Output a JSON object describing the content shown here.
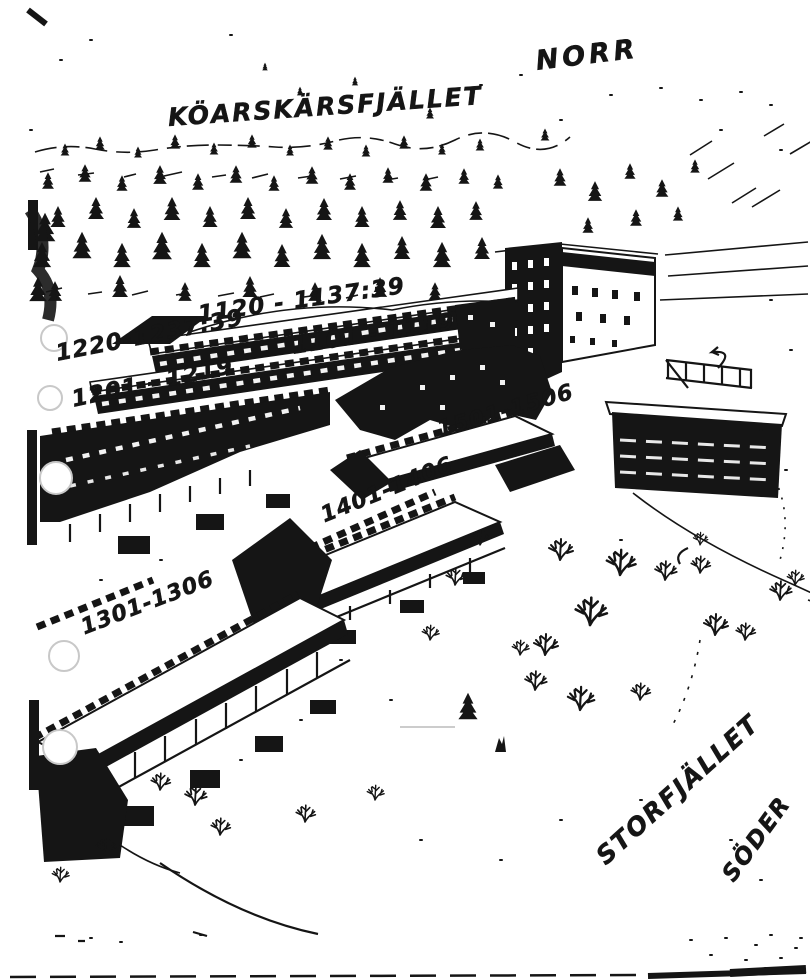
{
  "compass": {
    "north": "NORR",
    "south": "SÖDER"
  },
  "mountains": {
    "north_range": "KÖARSKÄRSFJÄLLET",
    "south_range": "STORFJÄLLET"
  },
  "buildings": [
    {
      "rooms": "1120 - 1137:39"
    },
    {
      "rooms": "1220-1237:39"
    },
    {
      "rooms": "1101 - 1119"
    },
    {
      "rooms": "1201 - 1219"
    },
    {
      "rooms": "1501-1506"
    },
    {
      "rooms": "1401-1406"
    },
    {
      "rooms": "1301-1306"
    }
  ],
  "colors": {
    "ink": "#151515",
    "paper": "#ffffff",
    "punch_hole_ring": "#c8c8c8"
  }
}
